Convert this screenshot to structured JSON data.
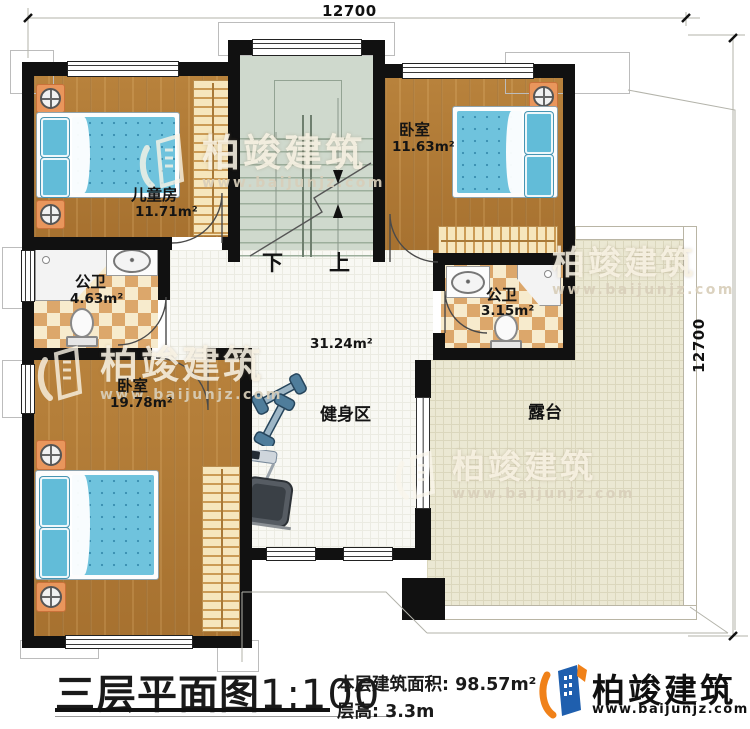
{
  "dims": {
    "top": "12700",
    "right": "12700"
  },
  "rooms": {
    "children": {
      "name": "儿童房",
      "area": "11.71m²"
    },
    "bedroom2": {
      "name": "卧室",
      "area": "11.63m²"
    },
    "bath1": {
      "name": "公卫",
      "area": "4.63m²"
    },
    "bath2": {
      "name": "公卫",
      "area": "3.15m²"
    },
    "bedroom1": {
      "name": "卧室",
      "area": "19.78m²"
    },
    "hall": {
      "area": "31.24m²"
    },
    "gym": {
      "name": "健身区"
    },
    "terrace": {
      "name": "露台"
    }
  },
  "stairs": {
    "down": "下",
    "up": "上"
  },
  "footer": {
    "title": "三层平面图",
    "scale": "1:100",
    "area_label": "本层建筑面积:",
    "area_value": "98.57m²",
    "floor_height_label": "层高:",
    "floor_height_value": "3.3m"
  },
  "brand": {
    "name": "柏竣建筑",
    "url": "www.baijunjz.com"
  },
  "watermark": {
    "text": "柏竣建筑",
    "url": "www.baijunjz.com"
  },
  "colors": {
    "wall": "#111111",
    "brand_blue": "#1f5fae",
    "brand_orange": "#f08119"
  }
}
